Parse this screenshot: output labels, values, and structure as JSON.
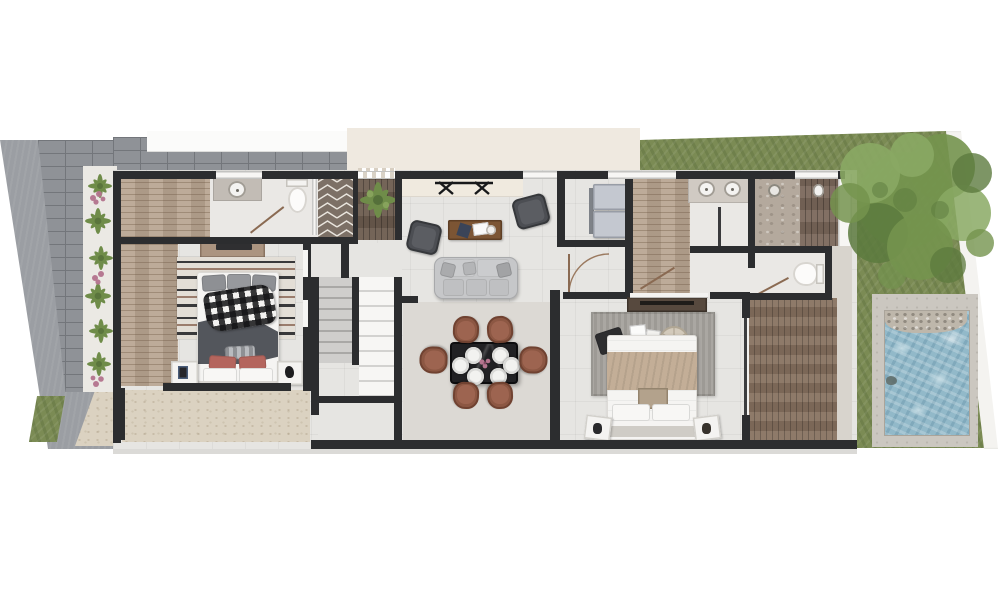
{
  "meta": {
    "kind": "architectural-floor-plan-render",
    "view": "top-down 3d render, single storey strip lot, no text labels visible"
  },
  "colors": {
    "background": "#ffffff",
    "wall": "#2c2d2f",
    "floor_main": "#e6e5e2",
    "floor_bath": "#eae8e5",
    "floor_dining": "#dcd9d4",
    "slab_edge": "#dbdad7",
    "terrace": "#dbd2c1",
    "driveway": "#9b9ea3",
    "paver": "#8f9297",
    "paver_line": "#73767b",
    "walk_white": "#fbfbfa",
    "sideyard": "#efe9e0",
    "planting_bg": "#ebe9e4",
    "plant_green": "#6f8c49",
    "plant_green_dark": "#55703a",
    "flower_pink": "#b4748e",
    "grass": "#7b8b54",
    "tree_light": "#8aa964",
    "tree_mid": "#74934e",
    "tree_dark": "#5c7a3e",
    "boundary_white": "#f4f3f0",
    "pool_deck": "#cbc7c0",
    "pool_water": "#92b9c9",
    "pool_ripple": "#c6dde5",
    "pebble": "#beb7ab",
    "wood_closet": "#b7a38f",
    "wood_entry": "#6b5b4e",
    "wood_deck": "#85705e",
    "wood_outdoor": "#7a675a",
    "chevron_brown": "#7c7066",
    "chevron_line": "#e9e5de",
    "shower_stone": "#b4a99d",
    "marble": "#c2bcb5",
    "counter_cream": "#f0eadf",
    "fixture": "#f4f3f1",
    "glass": "#f7f6f4",
    "concrete_walk": "#d8d4cd",
    "fridge": "#c4c8d0",
    "sofa": "#c6c7c9",
    "armchair": "#4c4e53",
    "coffee_table": "#7c5534",
    "dining_table": "#212124",
    "chair_brown": "#8c5743",
    "chair_brown_light": "#9d6450",
    "plate": "#f2f2f0",
    "rug1_base": "#e3ded6",
    "rug1_dark": "#39393b",
    "rug1_brown": "#9b7d6d",
    "bed_white": "#f5f4f2",
    "duvet_dark": "#53565c",
    "pillow_pink": "#b4655d",
    "pillow_gray": "#8e9094",
    "blanket_beige": "#c3ae97",
    "rug2": "#a5a29d",
    "pillow_dark": "#2d2d2f",
    "pillow_tan": "#c2ad93",
    "tray": "#d3cabb"
  },
  "floorplan": {
    "outdoor": [
      {
        "name": "driveway-carport",
        "contents": [
          "concrete drive",
          "grid pavers"
        ]
      },
      {
        "name": "planting-bed",
        "contents": [
          "spiky green plants",
          "pink flowering shrubs"
        ]
      },
      {
        "name": "front-terrace",
        "contents": [
          "speckled beige paving",
          "small lawn patch"
        ]
      },
      {
        "name": "backyard",
        "contents": [
          "lawn",
          "large tree",
          "angled white boundary wall"
        ]
      },
      {
        "name": "pool",
        "contents": [
          "blue water",
          "pebble beach entry",
          "concrete surround"
        ]
      },
      {
        "name": "wood-deck",
        "contents": [
          "vertical timber planks"
        ]
      }
    ],
    "rooms": [
      {
        "name": "walk-in-closet-1",
        "contents": [
          "timber floor"
        ]
      },
      {
        "name": "bathroom-1",
        "contents": [
          "vanity with round sink",
          "toilet",
          "herringbone-tiled shower"
        ]
      },
      {
        "name": "bedroom-1",
        "contents": [
          "double bed with plaid throw",
          "striped rug",
          "dresser with tv",
          "2 nightstands",
          "pink pillows"
        ]
      },
      {
        "name": "entry-hall",
        "contents": [
          "dark timber mat",
          "potted plant",
          "sliding front door"
        ]
      },
      {
        "name": "living-room",
        "contents": [
          "grey 3-seat sofa",
          "timber coffee table",
          "2 dark armchairs",
          "black console bench",
          "cream sideboard"
        ]
      },
      {
        "name": "staircase",
        "contents": [
          "u-shaped double flight",
          "grey flight",
          "white flight"
        ]
      },
      {
        "name": "dining-room",
        "contents": [
          "black stone table",
          "6 terracotta chairs",
          "6 white place settings",
          "flower centrepiece"
        ]
      },
      {
        "name": "pantry",
        "contents": [
          "double refrigerator"
        ]
      },
      {
        "name": "hallway",
        "contents": [
          "door swing arc"
        ]
      },
      {
        "name": "walk-in-closet-2",
        "contents": [
          "timber floor"
        ]
      },
      {
        "name": "bathroom-2",
        "contents": [
          "double vanity",
          "stone shower with rainhead",
          "outdoor timber shower with pendant"
        ]
      },
      {
        "name": "wc",
        "contents": [
          "toilet"
        ]
      },
      {
        "name": "bedroom-2",
        "contents": [
          "double bed",
          "grey rug",
          "round woven tray",
          "dark + tan cushions",
          "2 nightstands",
          "dark console",
          "glass slider to deck"
        ]
      }
    ]
  }
}
